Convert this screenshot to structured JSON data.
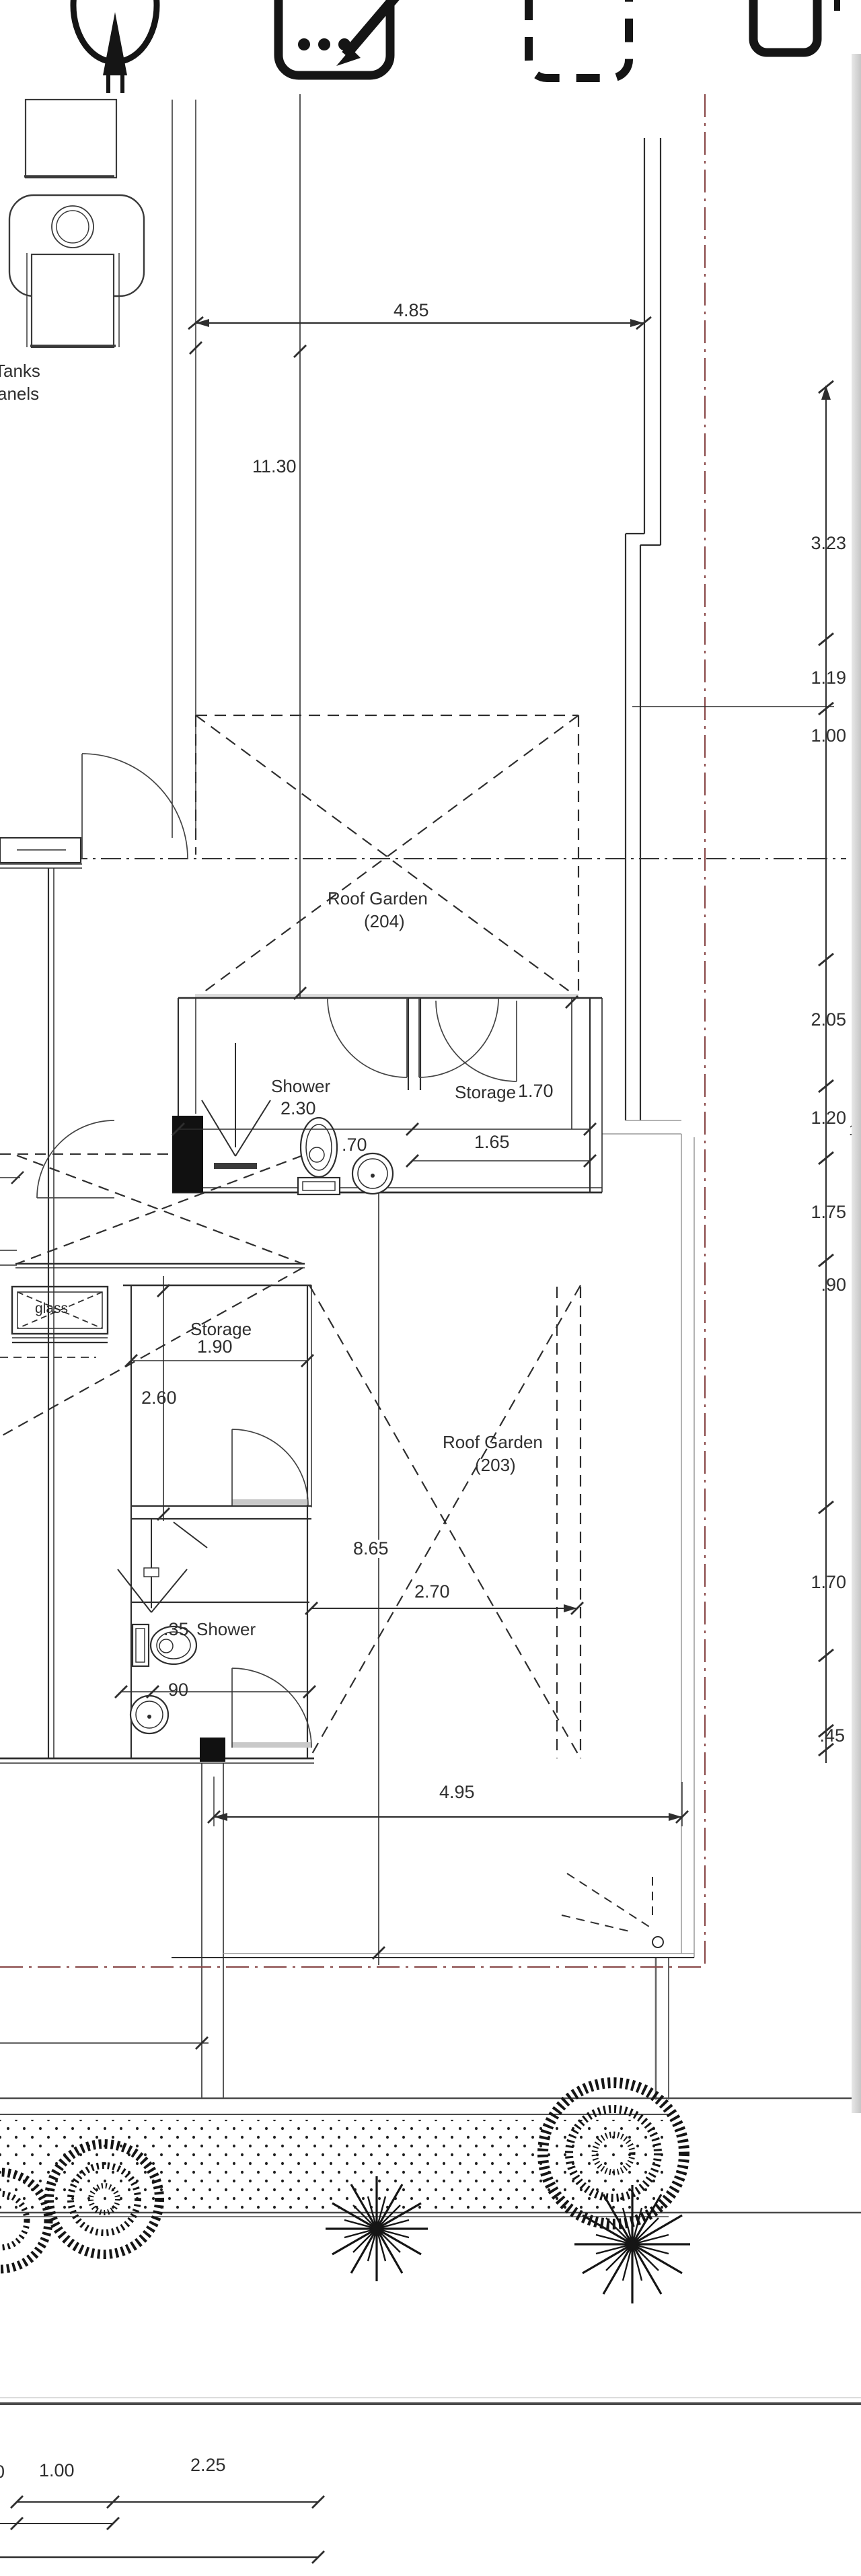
{
  "colors": {
    "ink": "#2b2b2b",
    "red_line": "#8a4a4a",
    "paper_edge": "#c6c6c6",
    "wall": "#333333"
  },
  "toolbar": {
    "icons": [
      {
        "label": "compass"
      },
      {
        "label": "markup-compose"
      },
      {
        "label": "dashed-selection"
      },
      {
        "label": "rounded-square"
      }
    ]
  },
  "equipment": {
    "label_line1": "Tanks",
    "label_line2": "anels"
  },
  "rooms": {
    "roof_garden_204_name": "Roof Garden",
    "roof_garden_204_number": "(204)",
    "roof_garden_203_name": "Roof Garden",
    "roof_garden_203_number": "(203)",
    "shower_upper": "Shower",
    "storage_upper": "Storage",
    "storage_lower": "Storage",
    "shower_lower": "Shower",
    "glass": "glass"
  },
  "dims": {
    "top_width": "4.85",
    "left_height": "11.30",
    "col_1": "3.23",
    "col_2": "1.19",
    "col_3": "1.00",
    "col_4": "2.05",
    "col_5": "1.20",
    "col_6": "1.75",
    "col_7": ".90",
    "col_8": "1.70",
    "col_9": ".45",
    "edge_partial_a": "2",
    "edge_partial_b": "1",
    "shower_width": "2.30",
    "shower_part": ".70",
    "storage_depth": "1.70",
    "storage_width": "1.65",
    "storage2_width": "1.90",
    "storage2_depth": "2.60",
    "garden_h": "8.65",
    "garden_w": "2.70",
    "toilet_off": ".35",
    "sink_w": "90",
    "terrace_w": "4.95",
    "street_partial": "0",
    "street_a": "1.00",
    "street_b": "2.25"
  }
}
